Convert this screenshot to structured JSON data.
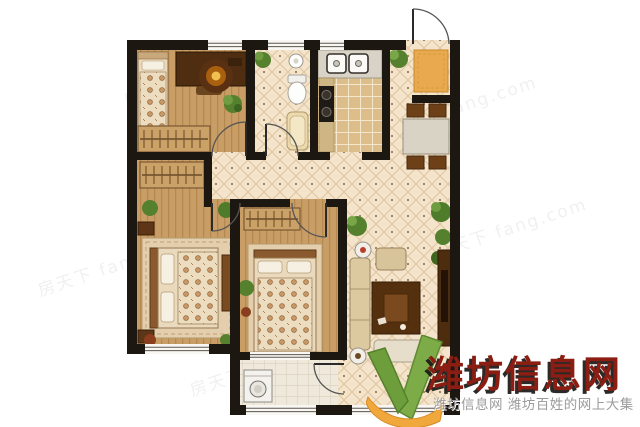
{
  "image": {
    "width": 640,
    "height": 427,
    "background": "#ffffff",
    "kind": "apartment floor plan"
  },
  "watermark": {
    "brand_text": "潍坊信息网",
    "brand_color": "#8b1d12",
    "tagline_text": "潍坊信息网 潍坊百姓的网上大集",
    "tagline_color": "#9b9b9b",
    "tiled_text": "房天下 fang.com",
    "logo": {
      "name": "weifang-info-v-logo",
      "green": "#7cab47",
      "orange": "#f0a83c"
    }
  },
  "floorplan": {
    "wall_color": "#1d1712",
    "floor_colors": {
      "wood": "#c99e66",
      "diamond_tile": "#f4e4cb",
      "kitchen_tile": "#ddbe8a",
      "balcony_tile": "#efe9dc"
    },
    "rooms": [
      {
        "name": "bedroom-top-left",
        "furniture": [
          "single-bed",
          "desk-with-lamp",
          "plant",
          "wardrobe"
        ]
      },
      {
        "name": "bathroom",
        "furniture": [
          "wash-basin",
          "toilet",
          "bathtub",
          "plant"
        ]
      },
      {
        "name": "kitchen",
        "furniture": [
          "double-sink",
          "stove",
          "counter"
        ]
      },
      {
        "name": "entrance-hall",
        "furniture": [
          "entry-door",
          "door-mat",
          "plant"
        ]
      },
      {
        "name": "dining-area",
        "furniture": [
          "dining-table",
          "four-chairs"
        ]
      },
      {
        "name": "living-room",
        "furniture": [
          "sofa-set",
          "armchair",
          "coffee-table",
          "rug",
          "tv-cabinet",
          "plants",
          "side-table"
        ]
      },
      {
        "name": "master-bedroom",
        "furniture": [
          "double-bed",
          "nightstands",
          "wardrobe",
          "dresser",
          "rug",
          "plants"
        ]
      },
      {
        "name": "bedroom-center",
        "furniture": [
          "double-bed",
          "wardrobe",
          "plant"
        ]
      },
      {
        "name": "balcony",
        "furniture": [
          "washing-machine"
        ]
      }
    ]
  }
}
